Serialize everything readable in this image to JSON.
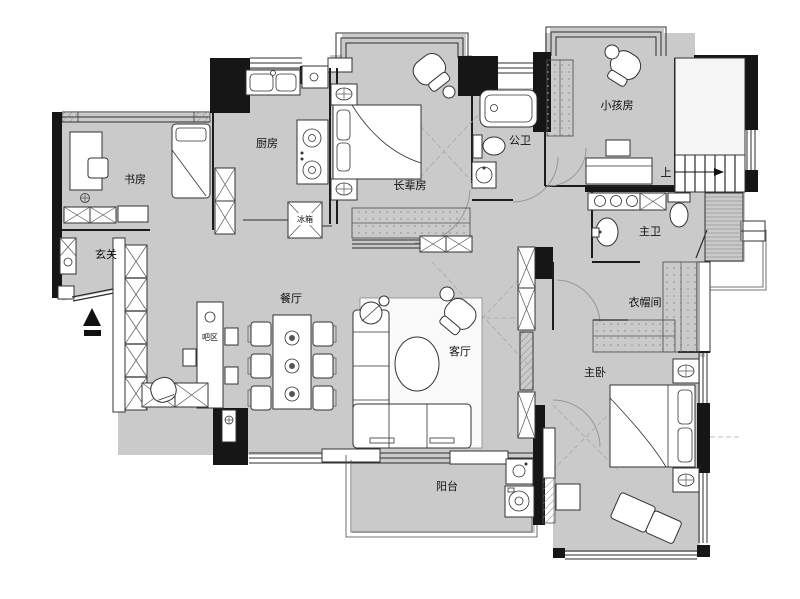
{
  "plan": {
    "type": "apartment-floor-plan",
    "colors": {
      "floor_fill": "#cacaca",
      "wall_fill": "#161616",
      "furniture_fill": "#ffffff",
      "outline": "#333333",
      "door_arc": "#979797",
      "background": "#ffffff"
    },
    "rooms": {
      "study": {
        "label": "书房"
      },
      "entry": {
        "label": "玄关"
      },
      "kitchen": {
        "label": "厨房"
      },
      "elder_room": {
        "label": "长辈房"
      },
      "public_bath": {
        "label": "公卫"
      },
      "kids_room": {
        "label": "小孩房"
      },
      "stairs": {
        "label": "上"
      },
      "master_bath": {
        "label": "主卫"
      },
      "cloakroom": {
        "label": "衣帽间"
      },
      "dining": {
        "label": "餐厅"
      },
      "bar": {
        "label": "吧区"
      },
      "living": {
        "label": "客厅"
      },
      "master_bedroom": {
        "label": "主卧"
      },
      "balcony": {
        "label": "阳台"
      }
    },
    "appliances": {
      "fridge": {
        "label": "冰箱"
      }
    }
  }
}
